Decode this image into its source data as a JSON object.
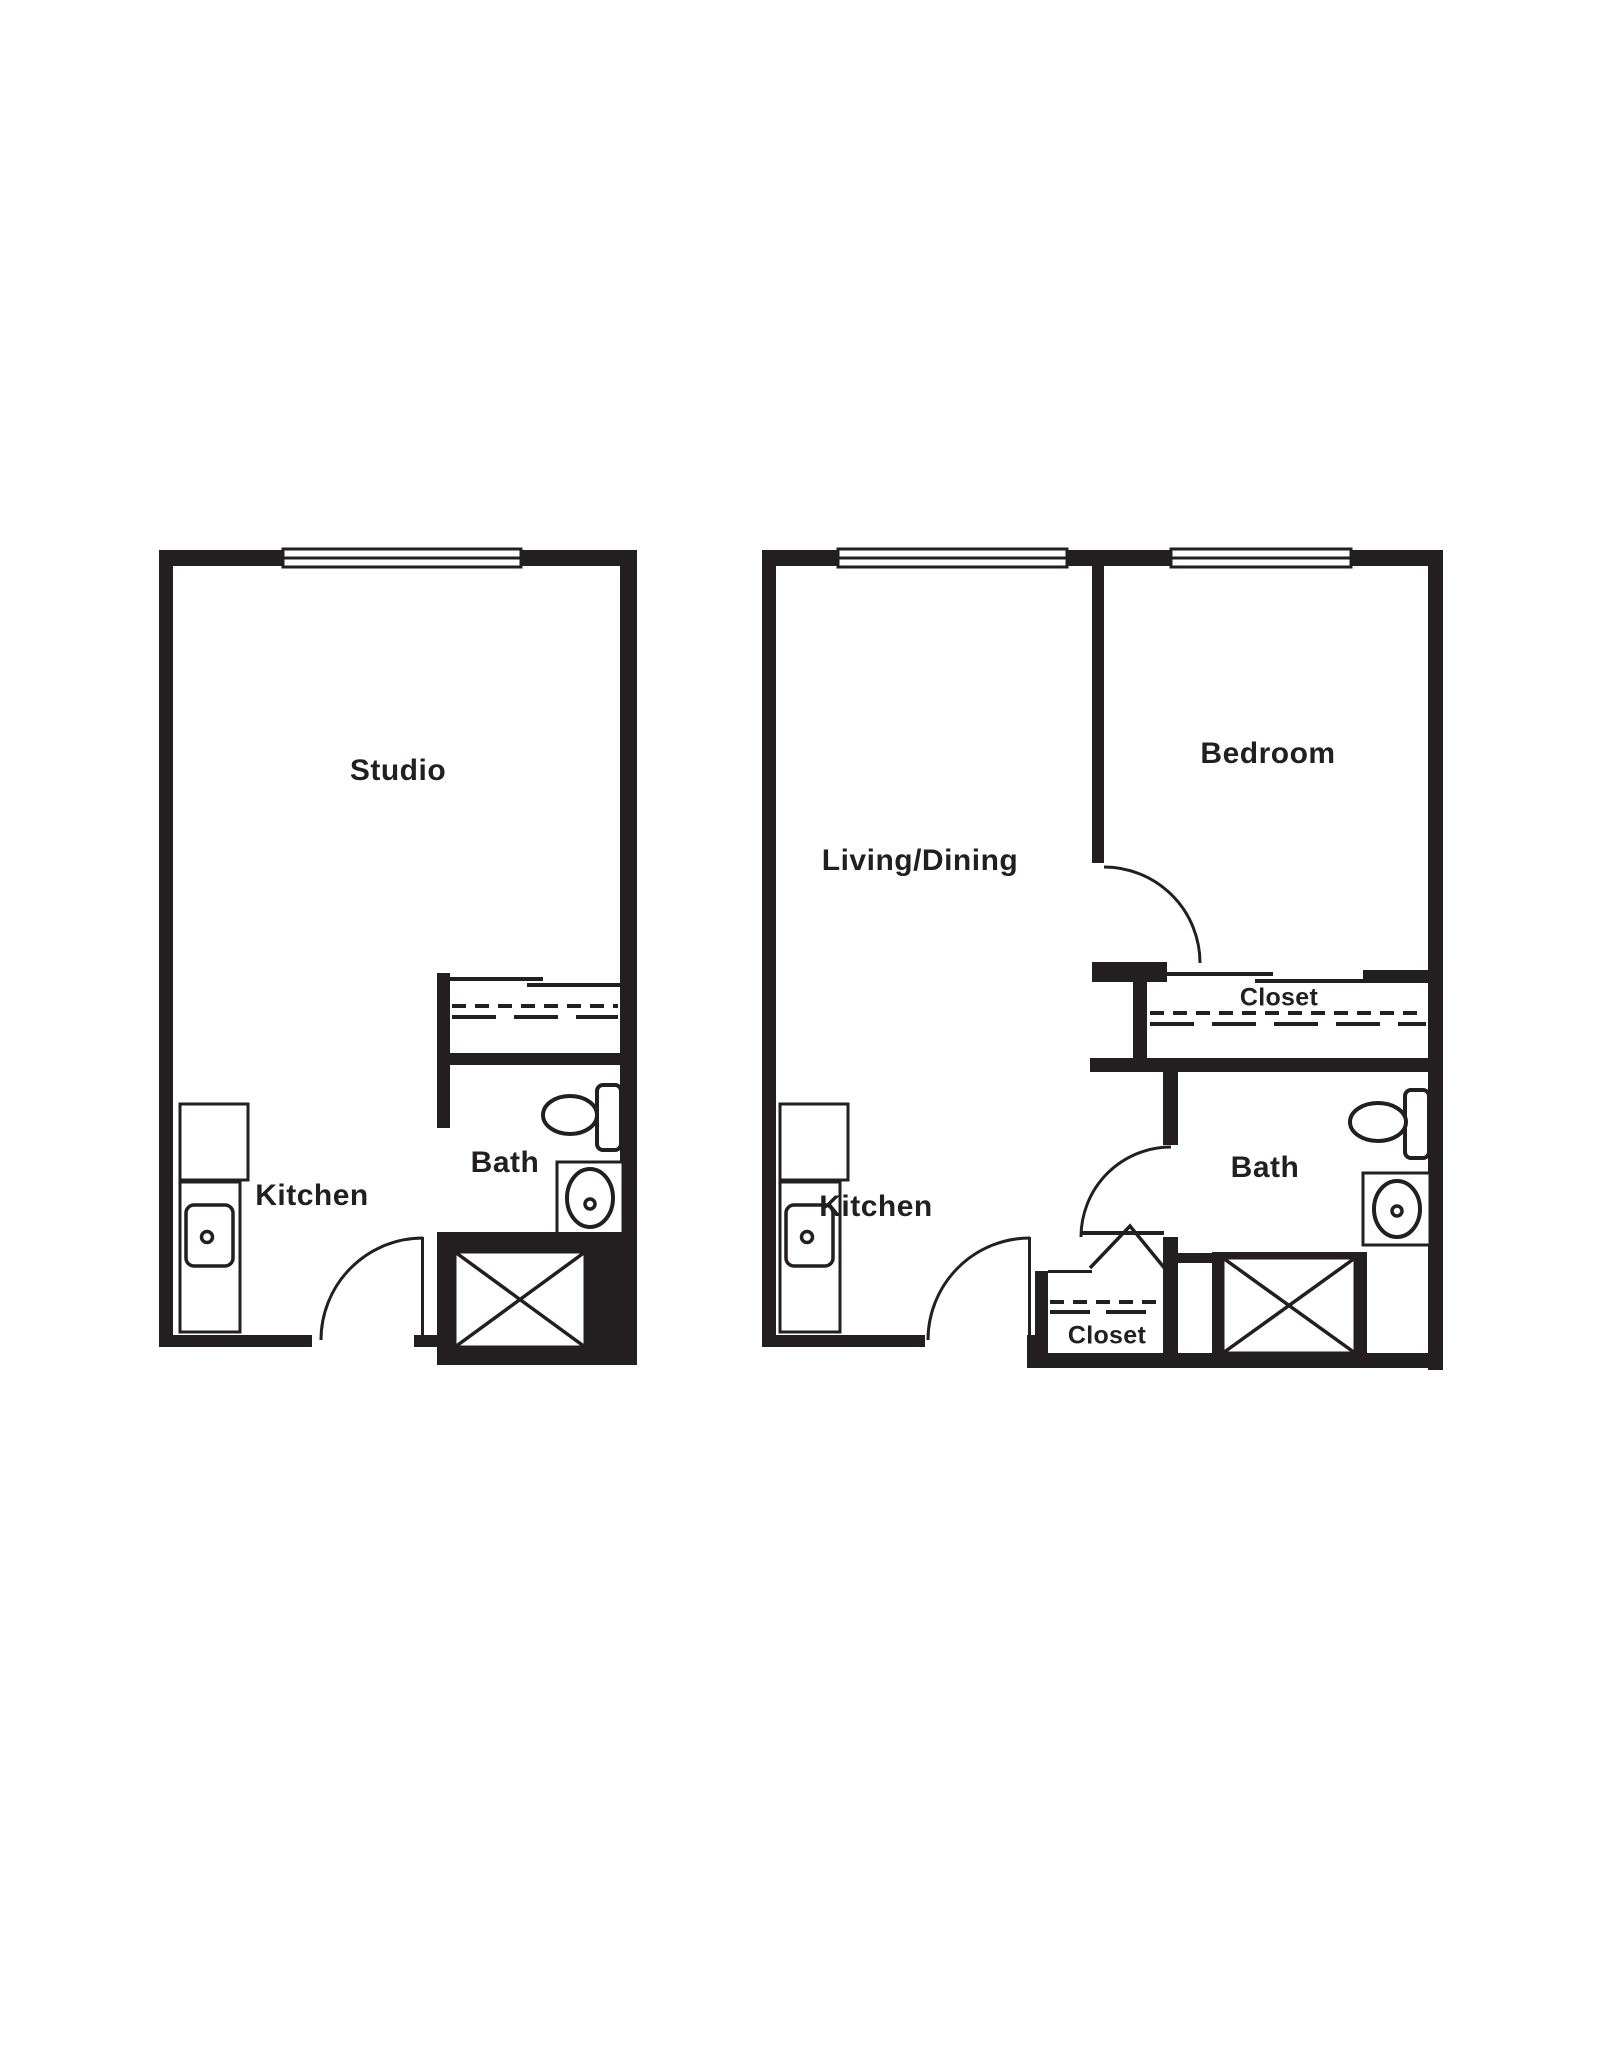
{
  "document": {
    "type": "apartment-floor-plans",
    "background_color": "#ffffff",
    "ink_color": "#231f20"
  },
  "plans": [
    {
      "name": "studio-unit",
      "labels": {
        "main": "Studio",
        "kitchen": "Kitchen",
        "bath": "Bath"
      }
    },
    {
      "name": "one-bedroom-unit",
      "labels": {
        "living": "Living/Dining",
        "bedroom": "Bedroom",
        "closet": "Closet",
        "kitchen": "Kitchen",
        "bath": "Bath",
        "entry_closet": "Closet"
      }
    }
  ],
  "fixtures": [
    "window",
    "door-swing",
    "bifold-door",
    "sliding-closet-doors",
    "closet-rod",
    "refrigerator",
    "kitchen-counter",
    "kitchen-sink",
    "toilet",
    "bathroom-sink",
    "shower"
  ]
}
